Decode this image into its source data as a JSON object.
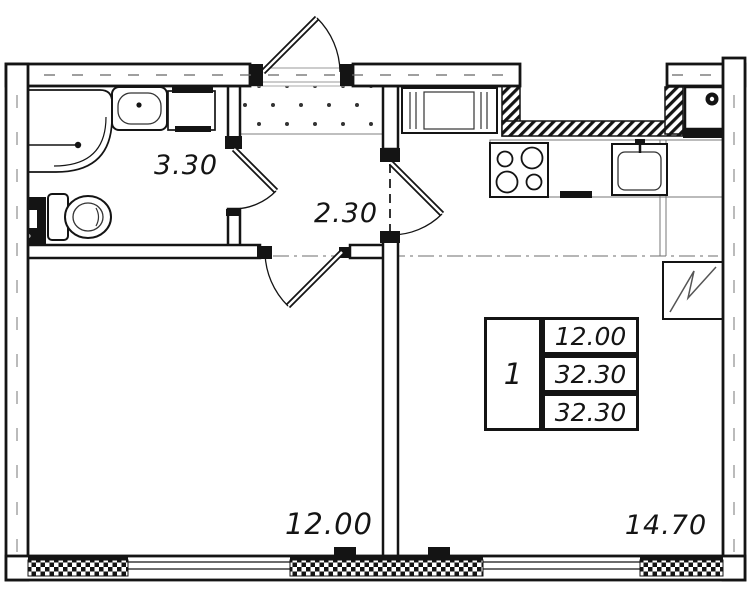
{
  "rooms": {
    "bathroom": {
      "area": "3.30"
    },
    "hallway": {
      "area": "2.30"
    },
    "living_room": {
      "area": "12.00"
    },
    "kitchen": {
      "area": "14.70"
    }
  },
  "stamp": {
    "rooms_count": "1",
    "living_area": "12.00",
    "area": "32.30",
    "total_area": "32.30"
  },
  "colors": {
    "line": "#141414",
    "background": "#ffffff",
    "counter_gray": "#777777"
  },
  "icons": {
    "shower": "corner-shower-icon",
    "toilet": "toilet-icon",
    "sink": "sink-icon",
    "washer": "washing-machine-icon",
    "stove": "stove-4-burner-icon",
    "fridge": "refrigerator-zigzag-icon"
  }
}
